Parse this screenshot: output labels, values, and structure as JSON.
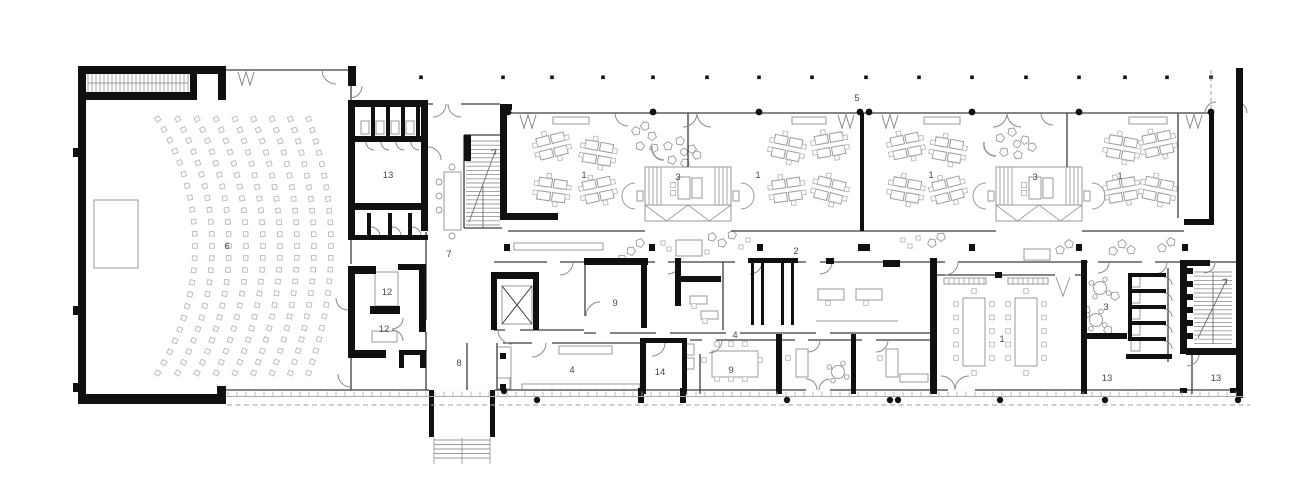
{
  "type": "architectural-floor-plan",
  "colors": {
    "background": "#ffffff",
    "wall": "#101010",
    "line": "#3c3c3c",
    "medium": "#6e6e6e",
    "furniture": "#9a9a9a",
    "seat": "#b9b9b9",
    "light": "#aaaaaa",
    "label": "#4a4a4a"
  },
  "rooms": [
    {
      "label": "6",
      "x": 227,
      "y": 249
    },
    {
      "label": "13",
      "x": 388,
      "y": 178
    },
    {
      "label": "7",
      "x": 449,
      "y": 257
    },
    {
      "label": "12",
      "x": 387,
      "y": 295
    },
    {
      "label": "12",
      "x": 384,
      "y": 332
    },
    {
      "label": "8",
      "x": 459,
      "y": 366
    },
    {
      "label": "4",
      "x": 572,
      "y": 373
    },
    {
      "label": "14",
      "x": 660,
      "y": 375
    },
    {
      "label": "9",
      "x": 615,
      "y": 306
    },
    {
      "label": "9",
      "x": 731,
      "y": 373
    },
    {
      "label": "4",
      "x": 735,
      "y": 338
    },
    {
      "label": "2",
      "x": 796,
      "y": 254
    },
    {
      "label": "5",
      "x": 857,
      "y": 101
    },
    {
      "label": "1",
      "x": 584,
      "y": 178
    },
    {
      "label": "3",
      "x": 678,
      "y": 180
    },
    {
      "label": "1",
      "x": 758,
      "y": 178
    },
    {
      "label": "1",
      "x": 931,
      "y": 178
    },
    {
      "label": "3",
      "x": 1035,
      "y": 180
    },
    {
      "label": "1",
      "x": 1120,
      "y": 179
    },
    {
      "label": "1",
      "x": 1002,
      "y": 342
    },
    {
      "label": "3",
      "x": 1106,
      "y": 310
    },
    {
      "label": "13",
      "x": 1107,
      "y": 381
    },
    {
      "label": "13",
      "x": 1216,
      "y": 381
    }
  ]
}
